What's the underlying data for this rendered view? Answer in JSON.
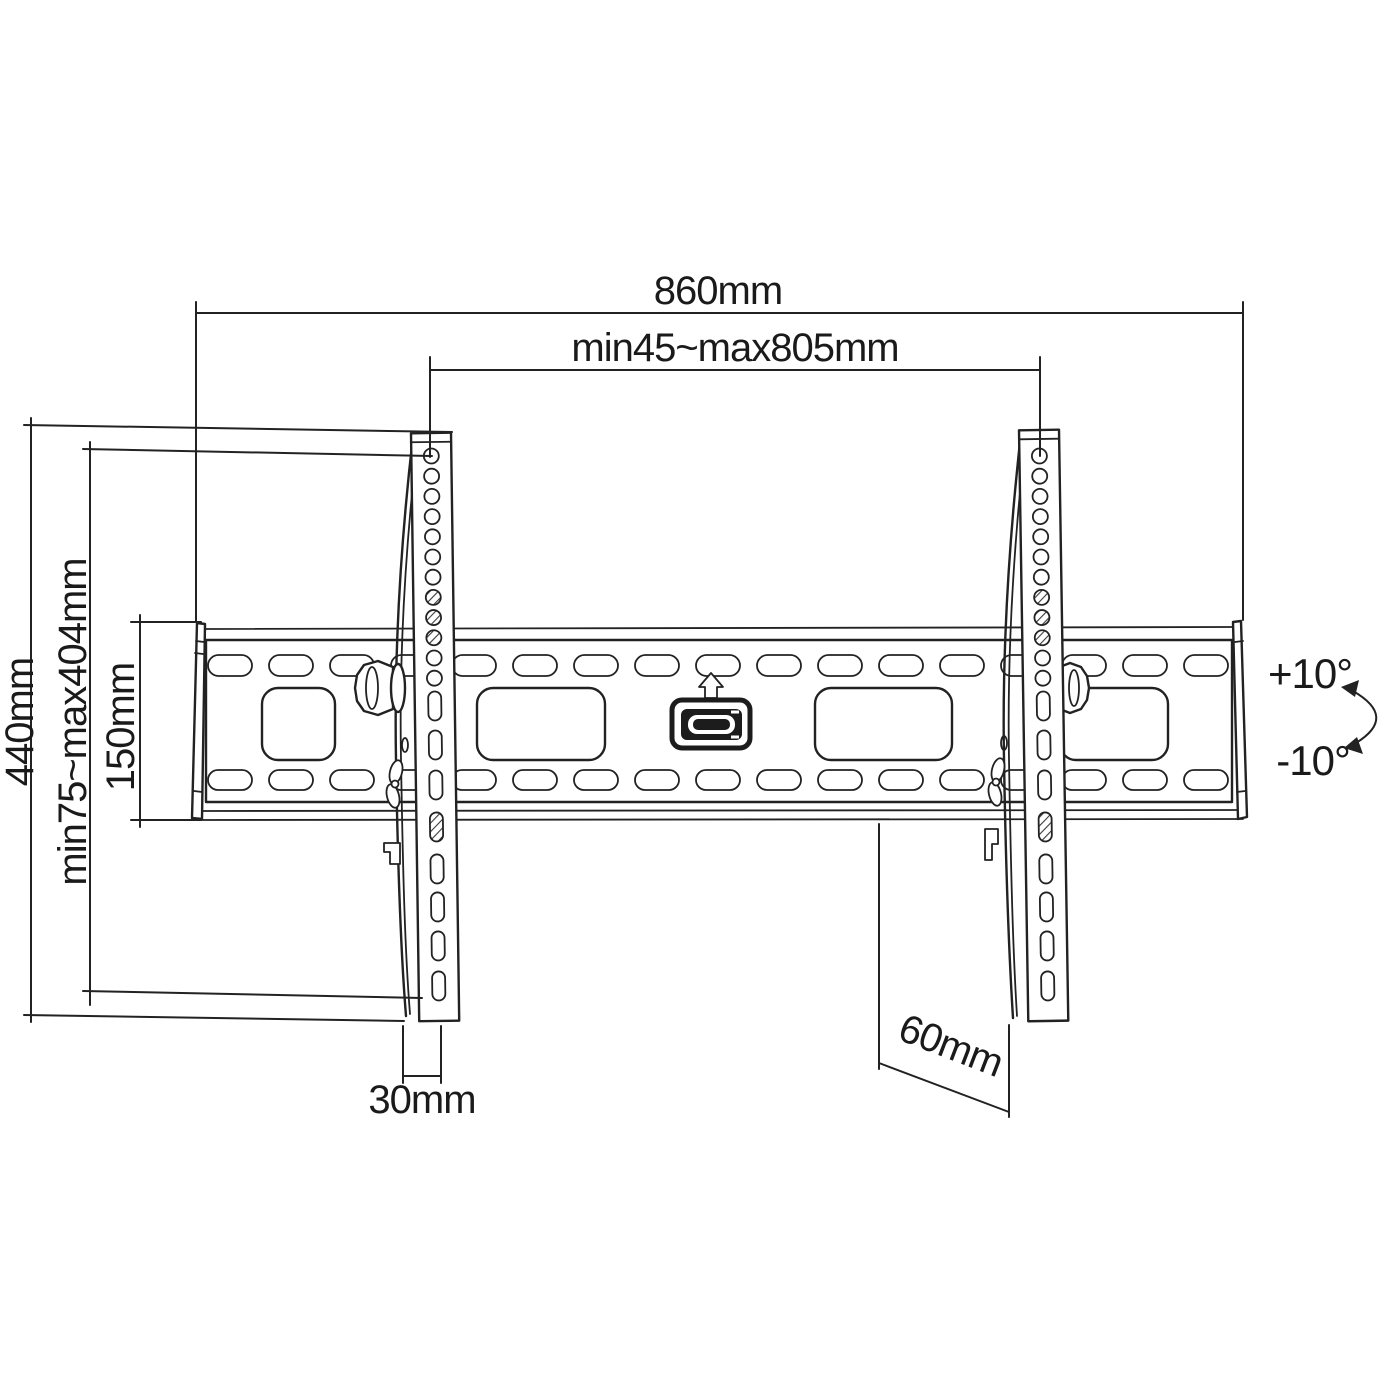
{
  "drawing": {
    "subject": "Tilting TV wall mount bracket dimensional drawing",
    "background": "#ffffff",
    "line_color": "#222222",
    "icons": {
      "latch_arrow": "up-arrow",
      "tilt_indicator": "curved-double-arrow"
    }
  },
  "dimensions": {
    "overall_width": "860mm",
    "mount_width_range": "min45~max805mm",
    "overall_height": "440mm",
    "mount_height_range": "min75~max404mm",
    "wall_plate_height": "150mm",
    "bracket_depth": "30mm",
    "bottom_clearance": "60mm",
    "tilt_up": "+10°",
    "tilt_down": "-10°"
  }
}
